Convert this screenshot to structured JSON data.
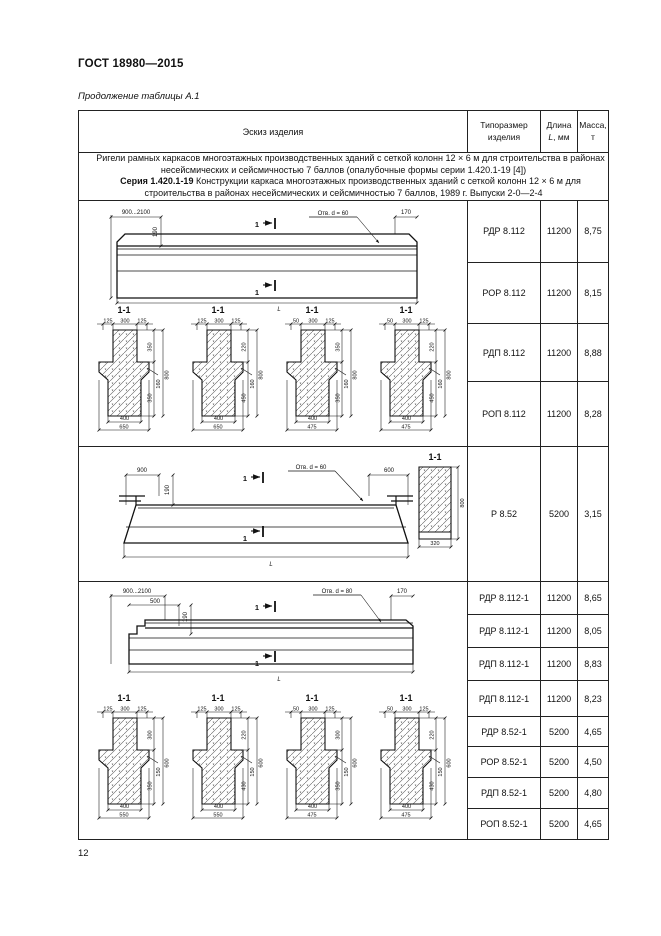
{
  "page": {
    "doc_number": "ГОСТ 18980—2015",
    "table_caption": "Продолжение таблицы А.1",
    "page_number": "12"
  },
  "table": {
    "headers": {
      "sketch": "Эскиз изделия",
      "type1": "Типоразмер",
      "type2": "изделия",
      "len1": "Длина",
      "len_it": "L",
      "len_unit": ", мм",
      "mass1": "Масса,",
      "mass2": "т"
    },
    "note": {
      "p1": "Ригели рамных каркасов многоэтажных производственных зданий с сеткой колонн 12 × 6 м для строительства в районах несейсмических и сейсмичностью 7 баллов (опалубочные формы серии 1.420.1-19 [4])",
      "p2_bold": "Серия 1.420.1-19",
      "p2_rest": " Конструкции каркаса многоэтажных производственных зданий с сеткой колонн 12 × 6 м для строительства в районах несейсмических и сейсмичностью 7 баллов, 1989 г. Выпуски 2-0—2-4"
    },
    "rows": [
      {
        "type": "РДР 8.112",
        "length": "11200",
        "mass": "8,75"
      },
      {
        "type": "РОР 8.112",
        "length": "11200",
        "mass": "8,15"
      },
      {
        "type": "РДП 8.112",
        "length": "11200",
        "mass": "8,88"
      },
      {
        "type": "РОП 8.112",
        "length": "11200",
        "mass": "8,28"
      },
      {
        "type": "Р 8.52",
        "length": "5200",
        "mass": "3,15"
      },
      {
        "type": "РДР 8.112-1",
        "length": "11200",
        "mass": "8,65"
      },
      {
        "type": "РДР 8.112-1",
        "length": "11200",
        "mass": "8,05"
      },
      {
        "type": "РДП 8.112-1",
        "length": "11200",
        "mass": "8,83"
      },
      {
        "type": "РДП 8.112-1",
        "length": "11200",
        "mass": "8,23"
      },
      {
        "type": "РДР 8.52-1",
        "length": "5200",
        "mass": "4,65"
      },
      {
        "type": "РОР 8.52-1",
        "length": "5200",
        "mass": "4,50"
      },
      {
        "type": "РДП 8.52-1",
        "length": "5200",
        "mass": "4,80"
      },
      {
        "type": "РОП 8.52-1",
        "length": "5200",
        "mass": "4,65"
      }
    ]
  },
  "drawings": {
    "e1": {
      "span": "900...2100",
      "h190": "190",
      "cut": "1",
      "hole": "Отв. d = 60",
      "d170": "170",
      "L": "L"
    },
    "s1": {
      "title": "1-1",
      "items": [
        {
          "t1": "125",
          "t2": "300",
          "t3": "125",
          "r1": "350",
          "r2": "160",
          "r3": "350",
          "h": "800",
          "b1": "400",
          "b2": "650"
        },
        {
          "t1": "125",
          "t2": "300",
          "t3": "125",
          "r1": "220",
          "r2": "160",
          "r3": "450",
          "h": "800",
          "b1": "400",
          "b2": "650"
        },
        {
          "t1": "50",
          "t2": "300",
          "t3": "125",
          "r1": "350",
          "r2": "160",
          "r3": "350",
          "h": "800",
          "b1": "400",
          "b2": "475"
        },
        {
          "t1": "50",
          "t2": "300",
          "t3": "125",
          "r1": "220",
          "r2": "160",
          "r3": "450",
          "h": "800",
          "b1": "400",
          "b2": "475"
        }
      ]
    },
    "e2": {
      "d900": "900",
      "h190": "190",
      "cut": "1",
      "hole": "Отв. d = 60",
      "d600": "600",
      "L": "L",
      "sec_title": "1-1",
      "sec_h": "800",
      "sec_w": "320"
    },
    "e3": {
      "span": "900...2100",
      "d500": "500",
      "h190": "190",
      "cut": "1",
      "hole": "Отв. d = 80",
      "d170": "170",
      "L": "L"
    },
    "s2": {
      "title": "1-1",
      "items": [
        {
          "t1": "125",
          "t2": "300",
          "t3": "125",
          "r1": "300",
          "r2": "150",
          "r3": "350",
          "h": "600",
          "b1": "400",
          "b2": "550"
        },
        {
          "t1": "125",
          "t2": "300",
          "t3": "125",
          "r1": "220",
          "r2": "150",
          "r3": "430",
          "h": "600",
          "b1": "400",
          "b2": "550"
        },
        {
          "t1": "50",
          "t2": "300",
          "t3": "125",
          "r1": "300",
          "r2": "150",
          "r3": "350",
          "h": "600",
          "b1": "400",
          "b2": "475"
        },
        {
          "t1": "50",
          "t2": "300",
          "t3": "125",
          "r1": "220",
          "r2": "150",
          "r3": "430",
          "h": "600",
          "b1": "400",
          "b2": "475"
        }
      ]
    }
  }
}
